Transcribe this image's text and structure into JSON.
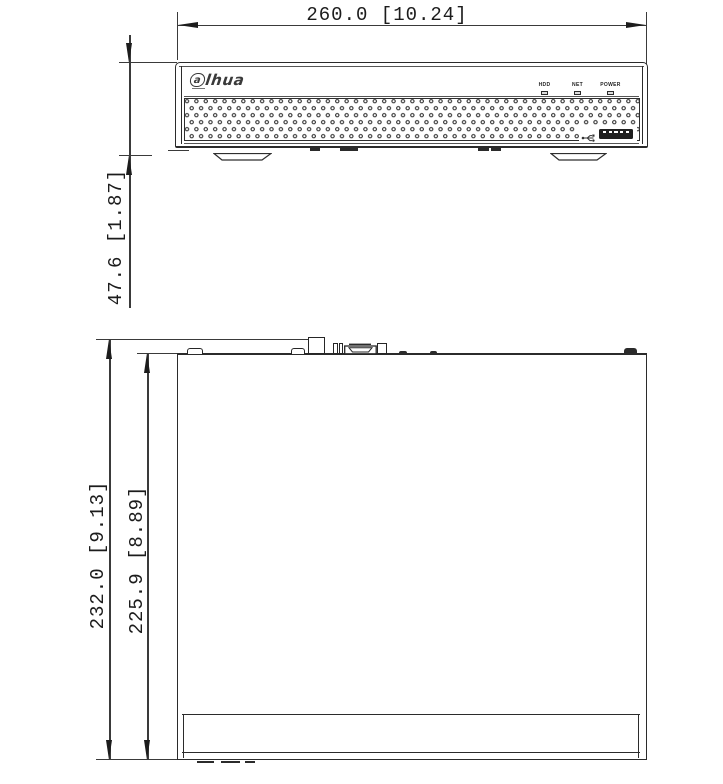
{
  "dimensions": {
    "width": "260.0 [10.24]",
    "height": "47.6 [1.87]",
    "depth_outer": "232.0 [9.13]",
    "depth_inner": "225.9 [8.89]"
  },
  "front_panel": {
    "logo_first_letter": "a",
    "logo_rest": "lhua",
    "led_labels": [
      "HDD",
      "NET",
      "POWER"
    ]
  },
  "icons": {
    "usb": "usb-trident-icon"
  },
  "colors": {
    "line": "#2b2b2b",
    "background": "#ffffff",
    "fill_dark": "#1f1f1f"
  }
}
